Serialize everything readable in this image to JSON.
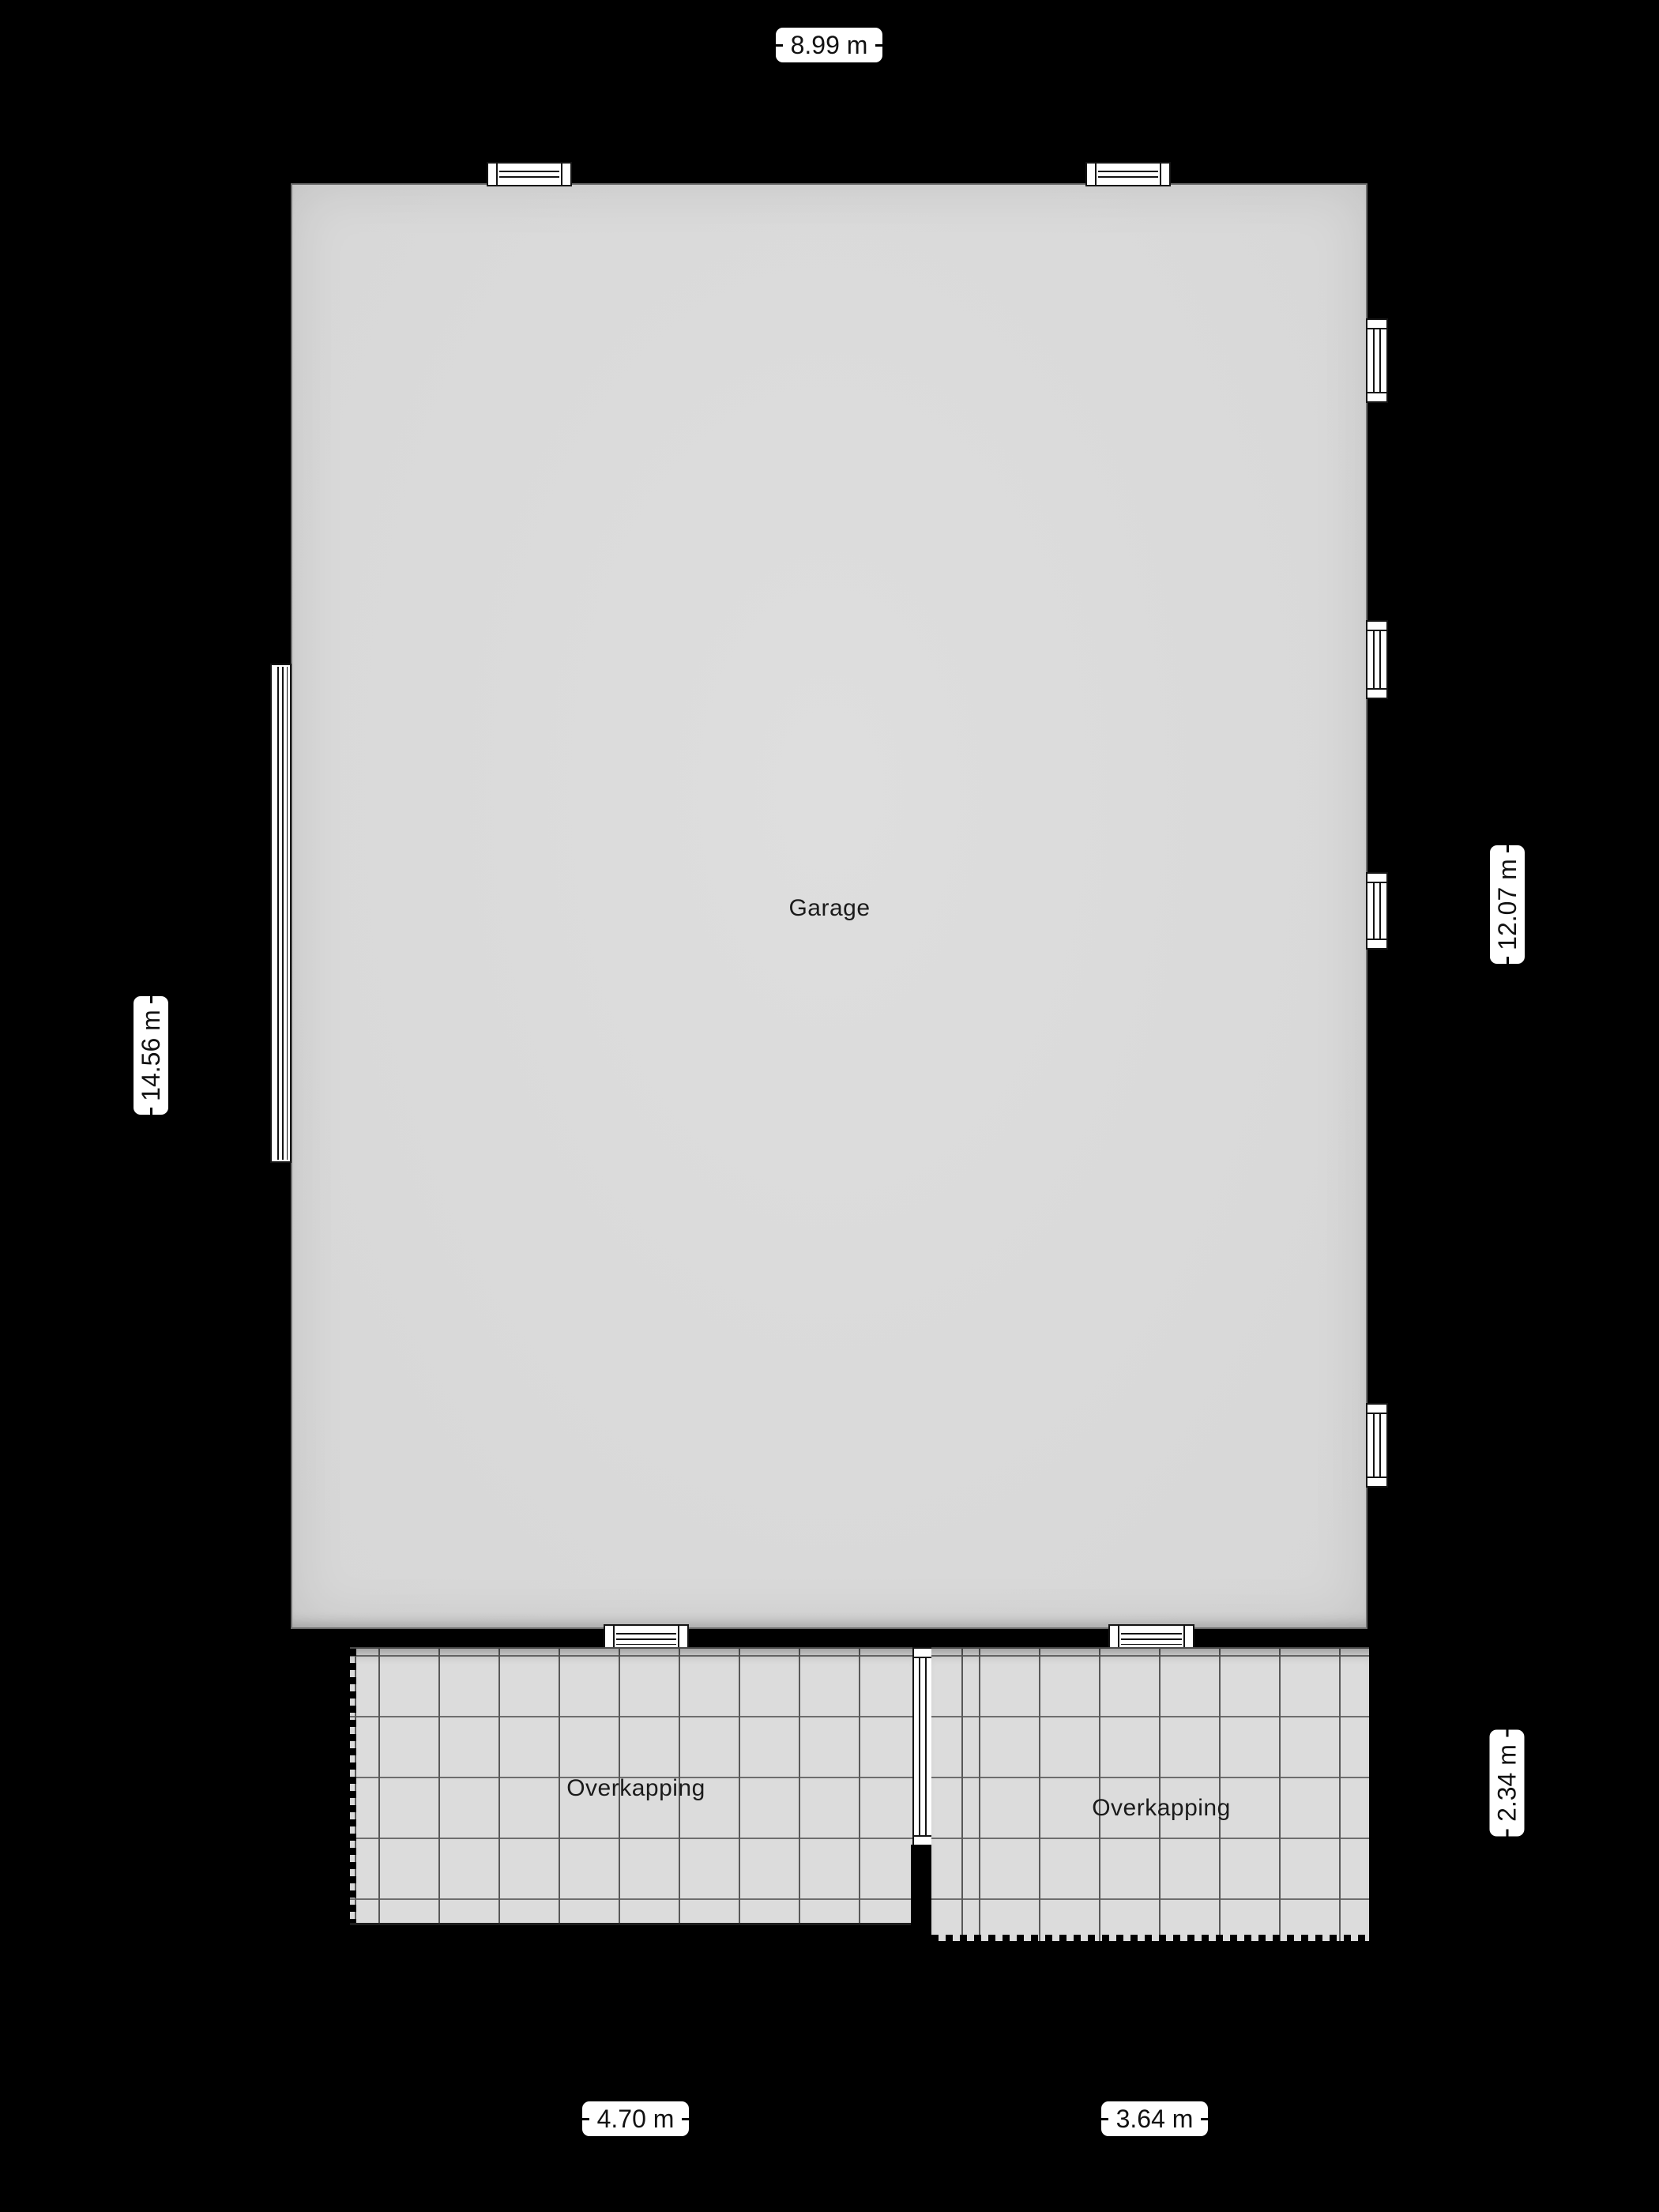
{
  "floorplan": {
    "garage": {
      "label": "Garage"
    },
    "overkapping_left": {
      "label": "Overkapping"
    },
    "overkapping_right": {
      "label": "Overkapping"
    },
    "dimensions": {
      "top_width": "8.99 m",
      "left_height": "14.56 m",
      "right_garage_height": "12.07 m",
      "right_overkapping_height": "2.34 m",
      "bottom_left_width": "4.70 m",
      "bottom_right_width": "3.64 m"
    },
    "windows": {
      "top_wall": 2,
      "left_wall": 1,
      "right_wall": 4,
      "bottom_wall": 2,
      "divider": 1
    },
    "colors": {
      "background": "#000000",
      "floor": "#dcdcdc",
      "grid_line": "#6e6e6e",
      "wall": "#000000",
      "window_fill": "#ffffff",
      "window_line": "#141414",
      "label_bg": "#ffffff",
      "label_text": "#111111"
    }
  }
}
